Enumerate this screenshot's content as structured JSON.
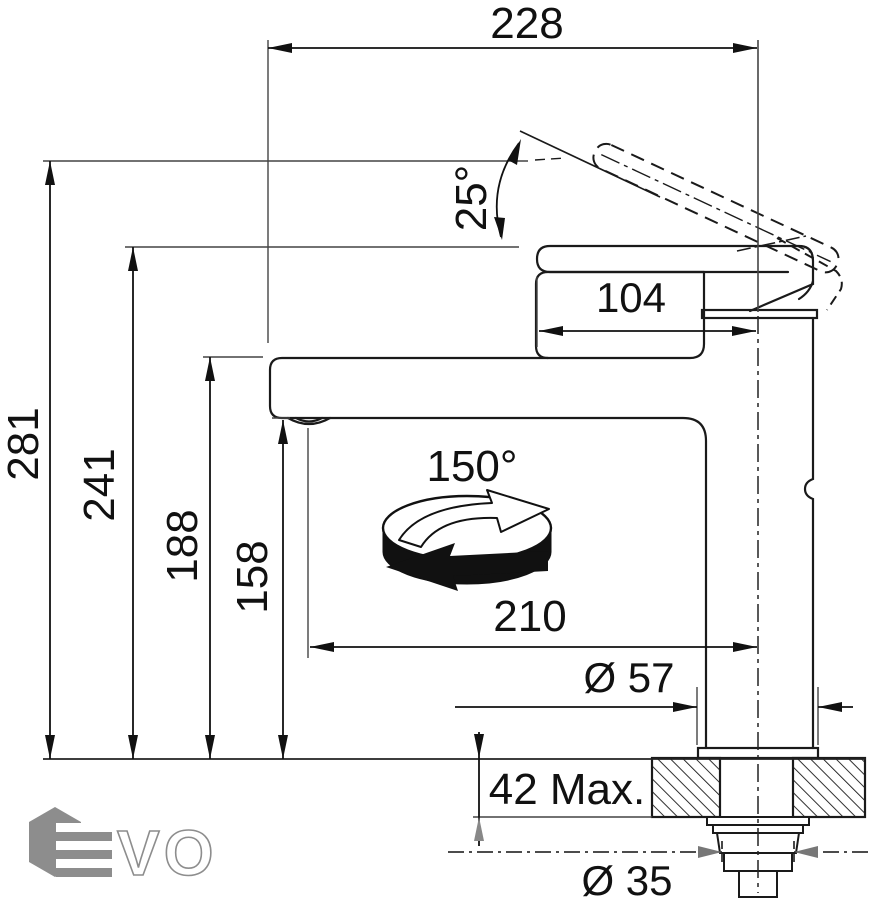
{
  "drawing_title": "faucet-dimension-drawing",
  "dims": {
    "overall_reach": "228",
    "lever_angle": "25°",
    "head_length": "104",
    "height_total": "281",
    "height_lever": "241",
    "height_spout_top": "188",
    "height_outlet": "158",
    "swivel_angle": "150°",
    "spout_reach": "210",
    "base_diameter": "Ø 57",
    "deck_thickness": "42 Max.",
    "hole_diameter": "Ø 35"
  },
  "logo": {
    "letters": "VO"
  },
  "colors": {
    "line": "#1a1a1a",
    "dim_line": "#111111",
    "ext_line": "#444444",
    "gray_arrow": "#777777",
    "logo_gray": "#8d8d8d",
    "background": "#ffffff"
  }
}
